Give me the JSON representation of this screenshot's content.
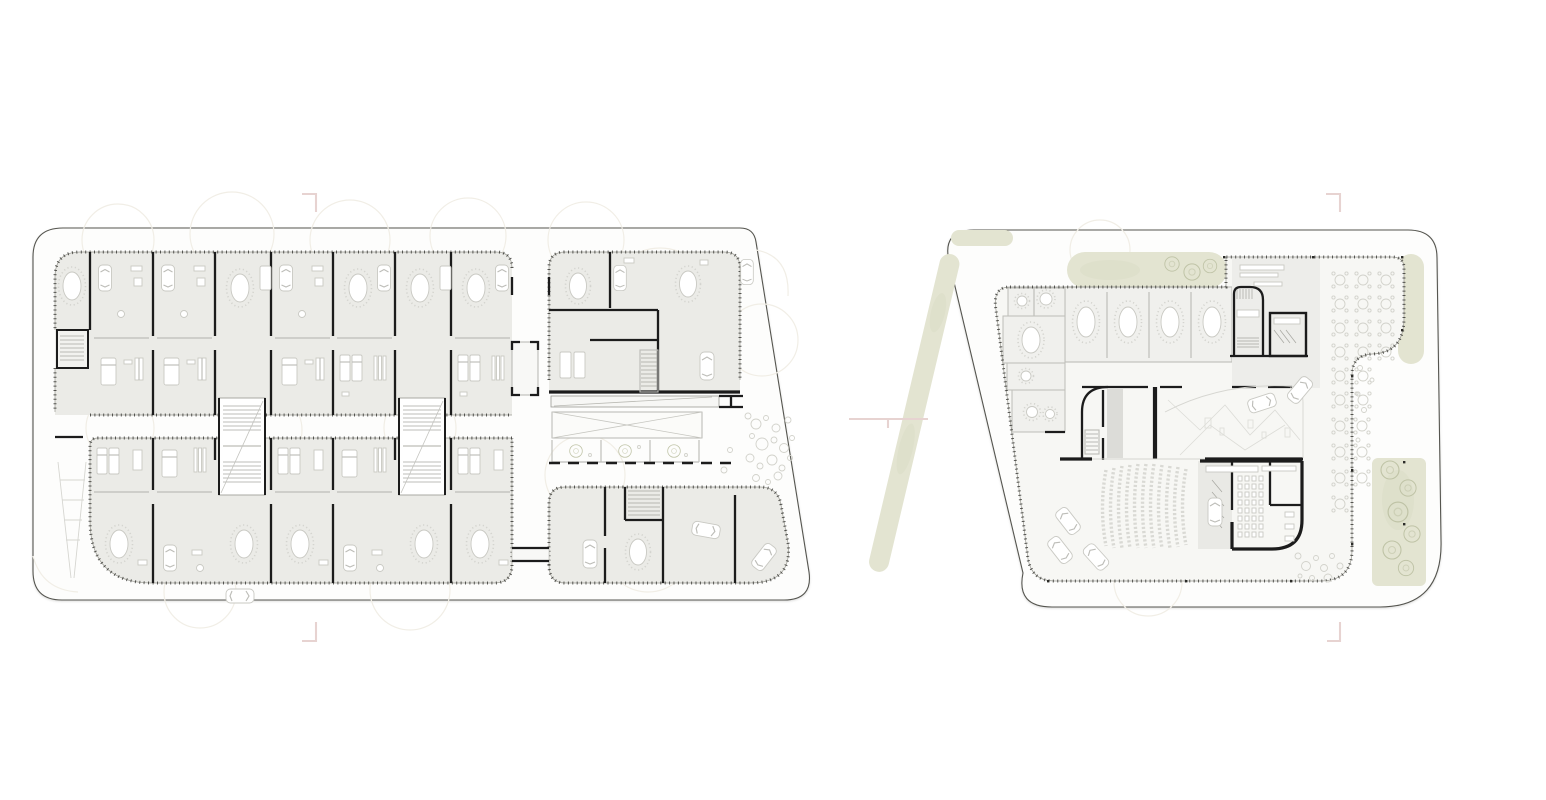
{
  "meta": {
    "type": "architectural-floor-plans",
    "plan_count": 2,
    "visible_text": ""
  },
  "colors": {
    "background": "#ffffff",
    "site_fill": "#fdfdfc",
    "site_stroke": "#55554f",
    "floor_fill": "#ebebe7",
    "right_floor_fill": "#f7f7f4",
    "room_fill": "#f0f0ed",
    "wall": "#1c1c1c",
    "partition": "#bdbdb8",
    "furniture_stroke": "#c9c9c3",
    "facade_tick": "#33332f",
    "green": "#e3e4d1",
    "tree_stroke": "#bfc3a6",
    "marker_pink": "#e7d3d1",
    "ghost_canopy": "#f1eee6",
    "seat_gray": "#d9d9d4",
    "shaft_gray": "#dcdcd8"
  },
  "left_plan": {
    "label": "left-floor-plan",
    "unit_columns_upper": 7,
    "unit_columns_lower": 7,
    "stair_cores": 2,
    "street_cars": 2,
    "has_center_corridor": true
  },
  "right_plan": {
    "label": "right-floor-plan",
    "auditorium_seat_rows": 11,
    "terrace_tables": 23,
    "parked_cars": 6,
    "meeting_tables": 4
  },
  "markers": {
    "section_ticks": 4,
    "center_tick": 1
  }
}
